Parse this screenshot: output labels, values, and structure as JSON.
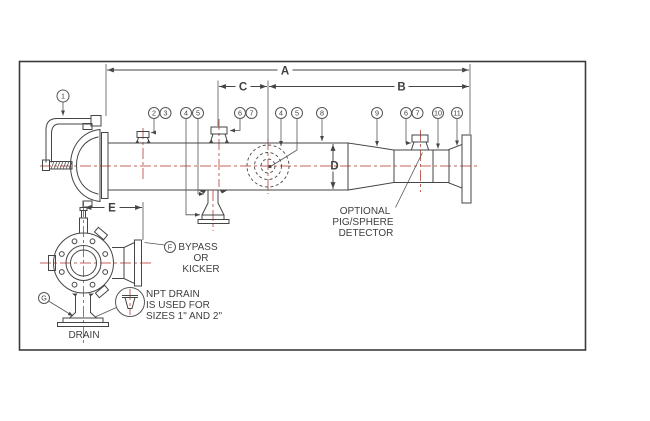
{
  "dims": {
    "a": "A",
    "b": "B",
    "c": "C",
    "d": "D",
    "e": "E"
  },
  "callout_1": "1",
  "callouts": [
    "2",
    "3",
    "4",
    "5",
    "6",
    "7",
    "4",
    "5",
    "8",
    "9",
    "6",
    "7",
    "10",
    "11"
  ],
  "letters": {
    "f": "F",
    "g": "G"
  },
  "notes": {
    "detector": [
      "OPTIONAL",
      "PIG/SPHERE",
      "DETECTOR"
    ],
    "bypass": [
      "BYPASS",
      "OR",
      "KICKER"
    ],
    "npt": [
      "NPT DRAIN",
      "IS USED FOR",
      "SIZES 1\" AND 2\""
    ],
    "drain": "DRAIN"
  },
  "colors": {
    "line": "#454545",
    "centerline": "#c4635c",
    "background": "#ffffff"
  }
}
